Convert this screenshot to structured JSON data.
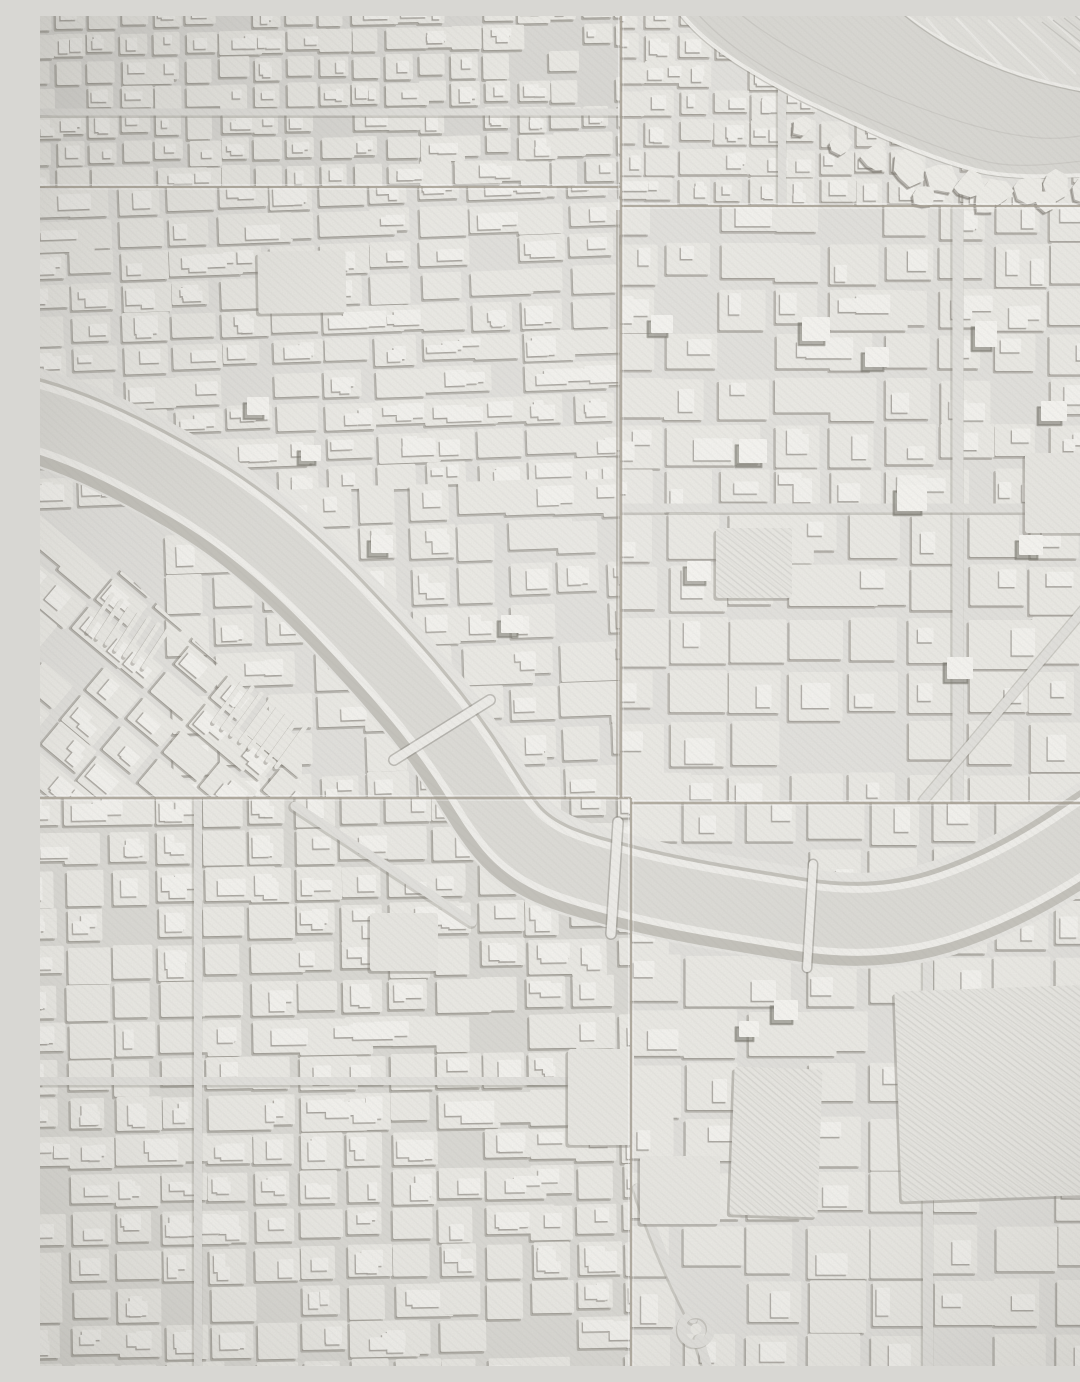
{
  "scene": {
    "w": 1080,
    "h": 1350
  },
  "palette": {
    "base": "#e0dfdb",
    "block": "#ebeae5",
    "blockShadow": "rgba(124,120,110,0.42)",
    "blockShadowDx": -2.3,
    "blockShadowDy": 2.6,
    "building": "#f4f3ef",
    "buildingShadow": "rgba(118,114,104,0.38)",
    "road": "#e2e1dd",
    "roadEdge": "rgba(118,114,104,0.28)",
    "riverLayers": [
      {
        "w": 96,
        "c": "#e7e6e2"
      },
      {
        "w": 84,
        "c": "rgba(118,114,104,0.32)",
        "t": "translate(-2.5 3)"
      },
      {
        "w": 70,
        "c": "#f0efeb"
      },
      {
        "w": 56,
        "c": "#dcdbd6"
      }
    ],
    "water": "#d9d8d3",
    "waterEdge": "#d2d1cc",
    "shoreHighlight": "#f1f0ec",
    "shoreShadow": "rgba(115,112,104,0.3)",
    "contour": "#c8c7c2",
    "fields": "#e2e1dc",
    "fieldLine": "#eeede9",
    "railLine": "#c9c8c3",
    "hill": "#efeee9",
    "hillShadow": "rgba(112,109,100,0.45)",
    "seam": "#a59e91",
    "seamHighlight1": "rgba(255,255,255,0.45)",
    "seamHighlight2": "rgba(255,255,255,0.3)",
    "tileGap": "rgba(140,133,120,0.45)",
    "parcel": "#e8e7e2",
    "hatchLine": "rgba(106,103,95,0.12)",
    "tall": "#f6f5f1",
    "tallShadow": "rgba(108,105,96,0.5)",
    "bridge": "#eeede9",
    "bridgeEdge": "rgba(115,112,104,0.4)",
    "overlayHatch": "rgba(120,118,110,0.045)",
    "vignetteEdge": "rgba(70,68,60,0.14)",
    "vignetteCenter": "rgba(255,255,255,0.06)",
    "cornerShade": "rgba(72,70,63,0.12)"
  },
  "tiles": [
    {
      "id": "t1",
      "name": "tile-top-left",
      "x": 0,
      "y": 0,
      "w": 581,
      "h": 171,
      "tint": "rgba(120,118,112,0.05)"
    },
    {
      "id": "t2",
      "name": "tile-top-right",
      "x": 581,
      "y": 0,
      "w": 499,
      "h": 190,
      "tint": "rgba(255,255,255,0.10)"
    },
    {
      "id": "t3",
      "name": "tile-mid-left",
      "x": 0,
      "y": 171,
      "w": 581,
      "h": 611,
      "tint": "rgba(255,255,255,0.03)"
    },
    {
      "id": "t4",
      "name": "tile-mid-right",
      "x": 581,
      "y": 190,
      "w": 499,
      "h": 597,
      "tint": "rgba(255,255,255,0.08)"
    },
    {
      "id": "t5",
      "name": "tile-bottom-left",
      "x": 0,
      "y": 782,
      "w": 591,
      "h": 568,
      "tint": "rgba(110,108,100,0.05)"
    },
    {
      "id": "t6",
      "name": "tile-bottom-right",
      "x": 591,
      "y": 787,
      "w": 489,
      "h": 563,
      "tint": "rgba(255,255,255,0.05)"
    }
  ],
  "clips": {
    "sw_polygon": "0,498 88,560 200,668 262,726 262,782 0,782"
  },
  "districts": [
    {
      "name": "district-top-left",
      "clip": "t1",
      "seed": 11,
      "x": -15,
      "y": -12,
      "w": 610,
      "h": 195,
      "cw": 26,
      "ch": 20,
      "sw": 7,
      "ang": -1,
      "rx": 290,
      "ry": 85,
      "skip": 0.05,
      "merge": 0.16,
      "jit": 3,
      "bld": 2
    },
    {
      "name": "district-top-right-shore",
      "clip": "t2",
      "seed": 22,
      "x": 572,
      "y": -10,
      "w": 360,
      "h": 210,
      "cw": 28,
      "ch": 22,
      "sw": 7,
      "ang": 0,
      "rx": 0,
      "ry": 0,
      "skip": 0.06,
      "merge": 0.12,
      "jit": 3,
      "bld": 2
    },
    {
      "name": "district-top-right-east",
      "clip": "t2",
      "seed": 23,
      "x": 925,
      "y": 148,
      "w": 165,
      "h": 50,
      "cw": 30,
      "ch": 18,
      "sw": 7,
      "ang": 0,
      "rx": 0,
      "ry": 0,
      "skip": 0.1,
      "merge": 0.1,
      "jit": 2,
      "bld": 1
    },
    {
      "name": "district-mid-left-upper",
      "clip": "t3",
      "seed": 33,
      "x": -15,
      "y": 165,
      "w": 610,
      "h": 312,
      "cw": 42,
      "ch": 24,
      "sw": 8,
      "ang": -2,
      "rx": 290,
      "ry": 320,
      "skip": 0.05,
      "merge": 0.2,
      "jit": 3,
      "bld": 3
    },
    {
      "name": "district-mid-left-lower",
      "clip": "t3",
      "seed": 44,
      "x": 130,
      "y": 471,
      "w": 465,
      "h": 318,
      "cw": 40,
      "ch": 32,
      "sw": 9,
      "ang": -2,
      "rx": 360,
      "ry": 630,
      "skip": 0.07,
      "merge": 0.15,
      "jit": 4,
      "bld": 2
    },
    {
      "name": "district-riverside-diagonal",
      "clip": "sw",
      "seed": 55,
      "x": -140,
      "y": 470,
      "w": 430,
      "h": 380,
      "cw": 42,
      "ch": 28,
      "sw": 8,
      "ang": 40,
      "rx": 60,
      "ry": 660,
      "skip": 0.07,
      "merge": 0.12,
      "jit": 3,
      "bld": 2
    },
    {
      "name": "district-mid-right-upper",
      "clip": "t4",
      "seed": 66,
      "x": 572,
      "y": 185,
      "w": 520,
      "h": 315,
      "cw": 46,
      "ch": 36,
      "sw": 9,
      "ang": 0,
      "rx": 0,
      "ry": 0,
      "skip": 0.06,
      "merge": 0.12,
      "jit": 3,
      "bld": 2
    },
    {
      "name": "district-mid-right-lower",
      "clip": "t4",
      "seed": 77,
      "x": 572,
      "y": 500,
      "w": 520,
      "h": 295,
      "cw": 50,
      "ch": 42,
      "sw": 10,
      "ang": 0,
      "rx": 0,
      "ry": 0,
      "skip": 0.08,
      "merge": 0.1,
      "jit": 4,
      "bld": 1
    },
    {
      "name": "district-bottom-left",
      "clip": "t5",
      "seed": 88,
      "x": -15,
      "y": 776,
      "w": 620,
      "h": 585,
      "cw": 38,
      "ch": 30,
      "sw": 8,
      "ang": -1,
      "rx": 290,
      "ry": 1060,
      "skip": 0.05,
      "merge": 0.15,
      "jit": 3,
      "bld": 3
    },
    {
      "name": "district-bottom-right",
      "clip": "t6",
      "seed": 99,
      "x": 585,
      "y": 780,
      "w": 510,
      "h": 582,
      "cw": 52,
      "ch": 44,
      "sw": 10,
      "ang": 0,
      "rx": 0,
      "ry": 0,
      "skip": 0.08,
      "merge": 0.12,
      "jit": 4,
      "bld": 1
    }
  ],
  "combs": [
    {
      "cx": 88,
      "cy": 615,
      "n": 7,
      "len": 44,
      "w": 4.5,
      "gap": 11,
      "dir": 33
    },
    {
      "cx": 220,
      "cy": 708,
      "n": 8,
      "len": 50,
      "w": 4.5,
      "gap": 11,
      "dir": 36
    }
  ],
  "parcels": [
    {
      "x": 218,
      "y": 235,
      "w": 88,
      "h": 62,
      "ang": -1,
      "style": "plain"
    },
    {
      "x": 676,
      "y": 512,
      "w": 76,
      "h": 70,
      "ang": 0,
      "style": "hatch"
    },
    {
      "x": 985,
      "y": 437,
      "w": 95,
      "h": 80,
      "ang": 0,
      "style": "plain"
    },
    {
      "x": 692,
      "y": 1052,
      "w": 88,
      "h": 148,
      "ang": 2,
      "style": "hatch"
    },
    {
      "x": 858,
      "y": 972,
      "w": 202,
      "h": 210,
      "ang": -2,
      "style": "hatch"
    },
    {
      "x": 330,
      "y": 897,
      "w": 68,
      "h": 58,
      "ang": 0,
      "style": "plain"
    },
    {
      "x": 528,
      "y": 1033,
      "w": 66,
      "h": 96,
      "ang": 0,
      "style": "plain"
    },
    {
      "x": 600,
      "y": 1140,
      "w": 80,
      "h": 68,
      "ang": 0,
      "style": "plain"
    }
  ],
  "tall_buildings": [
    [
      763,
      302,
      26,
      22
    ],
    [
      826,
      332,
      22,
      18
    ],
    [
      700,
      424,
      26,
      22
    ],
    [
      858,
      470,
      28,
      24
    ],
    [
      936,
      306,
      20,
      24
    ],
    [
      1002,
      386,
      24,
      18
    ],
    [
      648,
      546,
      22,
      18
    ],
    [
      908,
      642,
      24,
      20
    ],
    [
      612,
      300,
      20,
      16
    ],
    [
      980,
      520,
      22,
      18
    ],
    [
      208,
      382,
      20,
      16
    ],
    [
      262,
      430,
      18,
      14
    ],
    [
      332,
      520,
      20,
      16
    ],
    [
      462,
      600,
      20,
      16
    ],
    [
      735,
      985,
      22,
      18
    ],
    [
      700,
      1006,
      18,
      14
    ]
  ],
  "roads": [
    {
      "clip": "t5",
      "d": "M255,790 L432,906",
      "w": 9
    },
    {
      "clip": "t4",
      "d": "M918,192 L918,785",
      "w": 11
    },
    {
      "clip": "t6",
      "d": "M888,945 L888,1352",
      "w": 10
    },
    {
      "clip": "t4",
      "d": "M884,784 L1082,548",
      "w": 9
    },
    {
      "clip": "t6",
      "d": "M598,1172 C622,1244 645,1287 653,1303",
      "w": 9
    },
    {
      "clip": "t6",
      "d": "M659,1323 L668,1352",
      "w": 9
    },
    {
      "clip": "t2",
      "d": "M742,60 L742,190",
      "w": 8
    },
    {
      "clip": "t4",
      "d": "M581,492 L1082,492",
      "w": 9
    },
    {
      "clip": "t5",
      "d": "M-2,1065 L592,1065",
      "w": 8
    },
    {
      "clip": "t1",
      "d": "M-2,96 L582,96",
      "w": 7
    },
    {
      "clip": "t5",
      "d": "M158,782 L158,1352",
      "w": 8
    }
  ],
  "river": {
    "path": "M-15,398 C40,412 95,440 150,472 C210,507 260,552 305,600 C350,648 392,695 425,745 C445,775 452,790 470,812 C495,842 530,852 575,864 C640,881 700,890 760,900 C815,909 860,905 900,893 C945,879 990,856 1030,830 C1060,810 1080,796 1095,788"
  },
  "bridges": [
    [
      354,
      744,
      450,
      684,
      9
    ],
    [
      578,
      806,
      571,
      918,
      9
    ],
    [
      773,
      848,
      767,
      952,
      8
    ]
  ],
  "water": {
    "poly": "M640,-4 L864,-4 C900,26 948,50 999,64 C1033,73 1061,78 1086,80 L1086,157 C1024,160 973,164 932,153 C884,140 832,116 764,84 C706,54 664,28 640,-4 Z",
    "shore_near": "M640,-4 C664,28 706,54 764,84 C832,116 884,140 932,153 C972,164 1022,160 1086,157",
    "shore_far": "M864,-4 C900,26 948,50 999,64 C1033,73 1061,78 1086,80",
    "contours": [
      "M658,-2 C690,35 740,62 800,90 C860,116 905,136 948,146 C985,154 1030,146 1086,140",
      "M700,-2 C740,30 790,55 850,80 C900,100 950,118 1000,122 C1035,124 1062,116 1086,108"
    ],
    "fields_poly": "M864,-4 L1086,-4 L1086,78 C1061,76 1033,71 999,62 C948,48 900,24 864,-4 Z",
    "field_lines": [
      [
        886,
        2,
        954,
        78
      ],
      [
        916,
        2,
        984,
        74
      ],
      [
        948,
        4,
        1010,
        66
      ],
      [
        978,
        2,
        1036,
        58
      ],
      [
        1008,
        0,
        1060,
        48
      ],
      [
        1038,
        0,
        1078,
        36
      ]
    ],
    "rail_lines": [
      [
        1002,
        6,
        1058,
        50
      ],
      [
        1013,
        4,
        1069,
        48
      ],
      [
        1024,
        2,
        1080,
        46
      ],
      [
        1035,
        0,
        1080,
        36
      ],
      [
        1046,
        0,
        1080,
        28
      ],
      [
        1057,
        0,
        1080,
        20
      ]
    ],
    "hills_seed": 7,
    "hills": [
      [
        836,
        141,
        13
      ],
      [
        868,
        152,
        15
      ],
      [
        899,
        163,
        14
      ],
      [
        929,
        170,
        13
      ],
      [
        958,
        174,
        12
      ],
      [
        988,
        172,
        13
      ],
      [
        1018,
        169,
        12
      ],
      [
        1048,
        172,
        13
      ],
      [
        1072,
        176,
        11
      ],
      [
        884,
        180,
        10
      ],
      [
        946,
        186,
        10
      ],
      [
        1006,
        184,
        9
      ],
      [
        762,
        110,
        8
      ],
      [
        800,
        128,
        9
      ]
    ]
  },
  "roundabout": {
    "cx": 656,
    "cy": 1313,
    "r_outer": 15,
    "r_inner": 5.5
  },
  "tile_gaps": [
    [
      576,
      194,
      4,
      586
    ]
  ],
  "seams": [
    {
      "x1": 0,
      "y1": 171,
      "x2": 581,
      "y2": 171,
      "w": 2,
      "o": "h",
      "name": "seam-upper-left"
    },
    {
      "x1": 581,
      "y1": 190,
      "x2": 1080,
      "y2": 190,
      "w": 2,
      "o": "h",
      "name": "seam-upper-right"
    },
    {
      "x1": 0,
      "y1": 782,
      "x2": 591,
      "y2": 782,
      "w": 2.6,
      "o": "h",
      "name": "seam-lower-left"
    },
    {
      "x1": 591,
      "y1": 787,
      "x2": 1080,
      "y2": 787,
      "w": 2.6,
      "o": "h",
      "name": "seam-lower-right"
    },
    {
      "x1": 581,
      "y1": 0,
      "x2": 581,
      "y2": 782,
      "w": 2.4,
      "o": "v",
      "name": "seam-vertical-upper"
    },
    {
      "x1": 591,
      "y1": 782,
      "x2": 591,
      "y2": 1350,
      "w": 2.2,
      "o": "v",
      "name": "seam-vertical-lower"
    }
  ],
  "grain": {
    "base_frequency": 0.8,
    "octaves": 2,
    "seed": 7,
    "opacity": 0.5
  }
}
